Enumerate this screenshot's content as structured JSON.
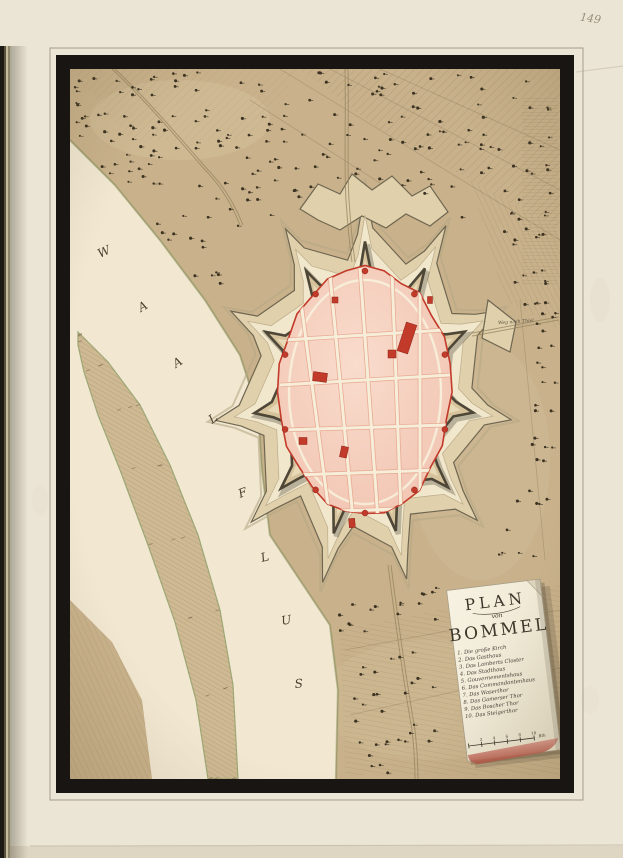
{
  "page": {
    "number": "149"
  },
  "plate": {
    "river_label_letters": [
      "W",
      "A",
      "A",
      "L",
      "F",
      "L",
      "U",
      "S"
    ],
    "road_label": "Weg nach Thiel",
    "cartouche": {
      "title": "PLAN",
      "subtitle": "von",
      "name": "BOMMEL",
      "legend": [
        "1. Die große Kirch",
        "2. Das Gasthaus",
        "3. Das Lamberts Closter",
        "4. Das Stadthaus",
        "5. Gouvernementshaus",
        "6. Das Commandantenhaus",
        "7. Das Waserthor",
        "8. Das Gamerser Thor",
        "9. Das Boscher Thor",
        "10. Das Steigerthor"
      ],
      "scale_ticks": [
        "2",
        "4",
        "6",
        "8",
        "10"
      ],
      "scale_unit": "Rth"
    },
    "colors": {
      "paper": "#ebe5d6",
      "frame": "#181512",
      "terrain": "#c9b28b",
      "river": "#f2e8d2",
      "city_pink": "#f4cdbc",
      "accent_red": "#c23a2a"
    }
  }
}
